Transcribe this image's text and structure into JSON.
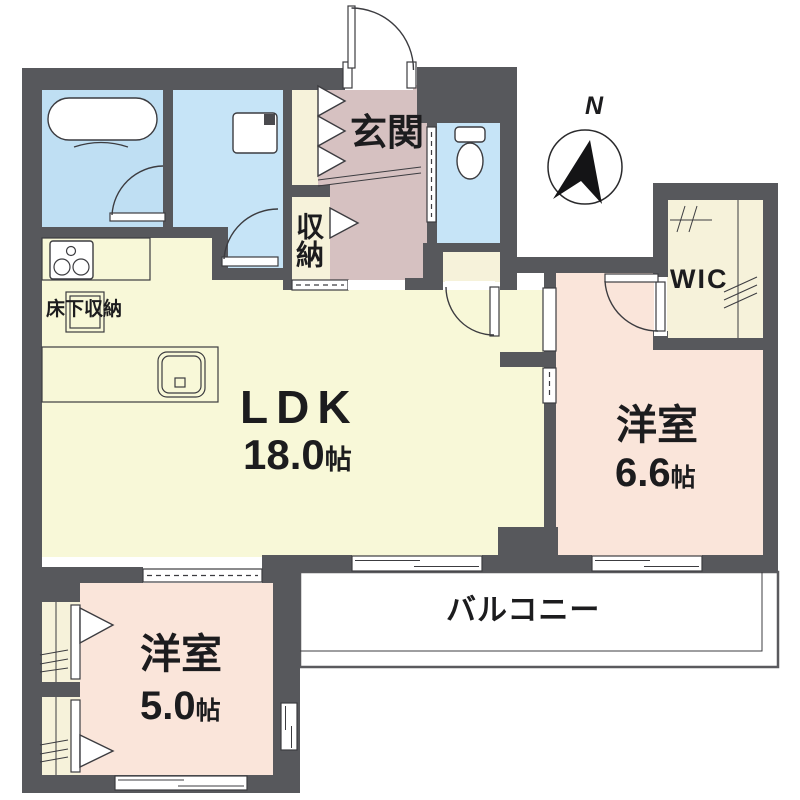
{
  "floor_plan": {
    "compass_north": "N",
    "rooms": {
      "entrance": {
        "label": "玄関"
      },
      "storage": {
        "label": "収納"
      },
      "ldk": {
        "label": "LDK",
        "size": "18.0",
        "unit": "帖"
      },
      "bedroom_east": {
        "label": "洋室",
        "size": "6.6",
        "unit": "帖"
      },
      "bedroom_south": {
        "label": "洋室",
        "size": "5.0",
        "unit": "帖"
      },
      "walk_in_closet": {
        "label": "WIC"
      },
      "balcony": {
        "label": "バルコニー"
      },
      "underfloor_storage": {
        "label": "床下収納"
      }
    },
    "colors": {
      "wall": "#57585c",
      "wet_area_floor": "#c6e4f7",
      "bath_floor": "#bfdff3",
      "ldk_floor": "#f8f8d8",
      "hall_floor": "#d6c1c1",
      "bedroom_floor": "#fae5da",
      "closet_floor": "#f6f2da",
      "line": "#3c3c40"
    }
  }
}
